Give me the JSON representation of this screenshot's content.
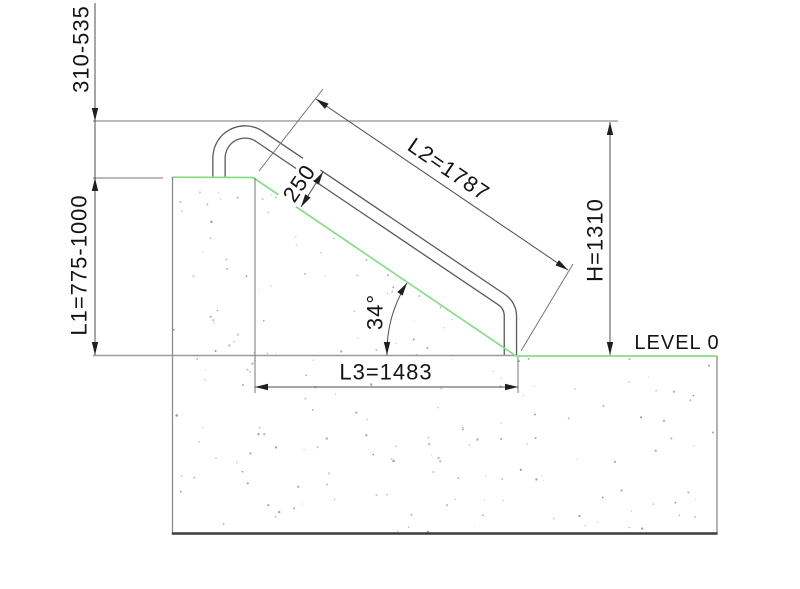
{
  "title": "Handrail on sloped embankment - dimensioned side view",
  "labels": {
    "offset_top": "310-535",
    "l1": "L1=775-1000",
    "l2": "L2=1787",
    "rail_clearance": "250",
    "h": "H=1310",
    "angle": "34°",
    "l3": "L3=1483",
    "level": "LEVEL 0"
  },
  "dimensions": [
    {
      "name": "top-overhang-range",
      "label": "310-535"
    },
    {
      "name": "L1",
      "label": "L1=775-1000"
    },
    {
      "name": "L2",
      "label": "L2=1787"
    },
    {
      "name": "rail-clearance",
      "label": "250"
    },
    {
      "name": "H",
      "label": "H=1310"
    },
    {
      "name": "slope-angle",
      "label": "34°"
    },
    {
      "name": "L3",
      "label": "L3=1483"
    },
    {
      "name": "ground-reference",
      "label": "LEVEL 0"
    }
  ],
  "colors": {
    "surface_green": "#86dd86",
    "concrete_edge": "#8c8c8c",
    "ground_base_line": "#3c3c3c",
    "dimension_line": "#4d4d4d",
    "extension_line": "#777777",
    "tube_outline": "#5a5a5a",
    "arrow": "#1f1f1f",
    "text": "#141414",
    "stipple": "#a0a0a0",
    "background": "#ffffff"
  }
}
